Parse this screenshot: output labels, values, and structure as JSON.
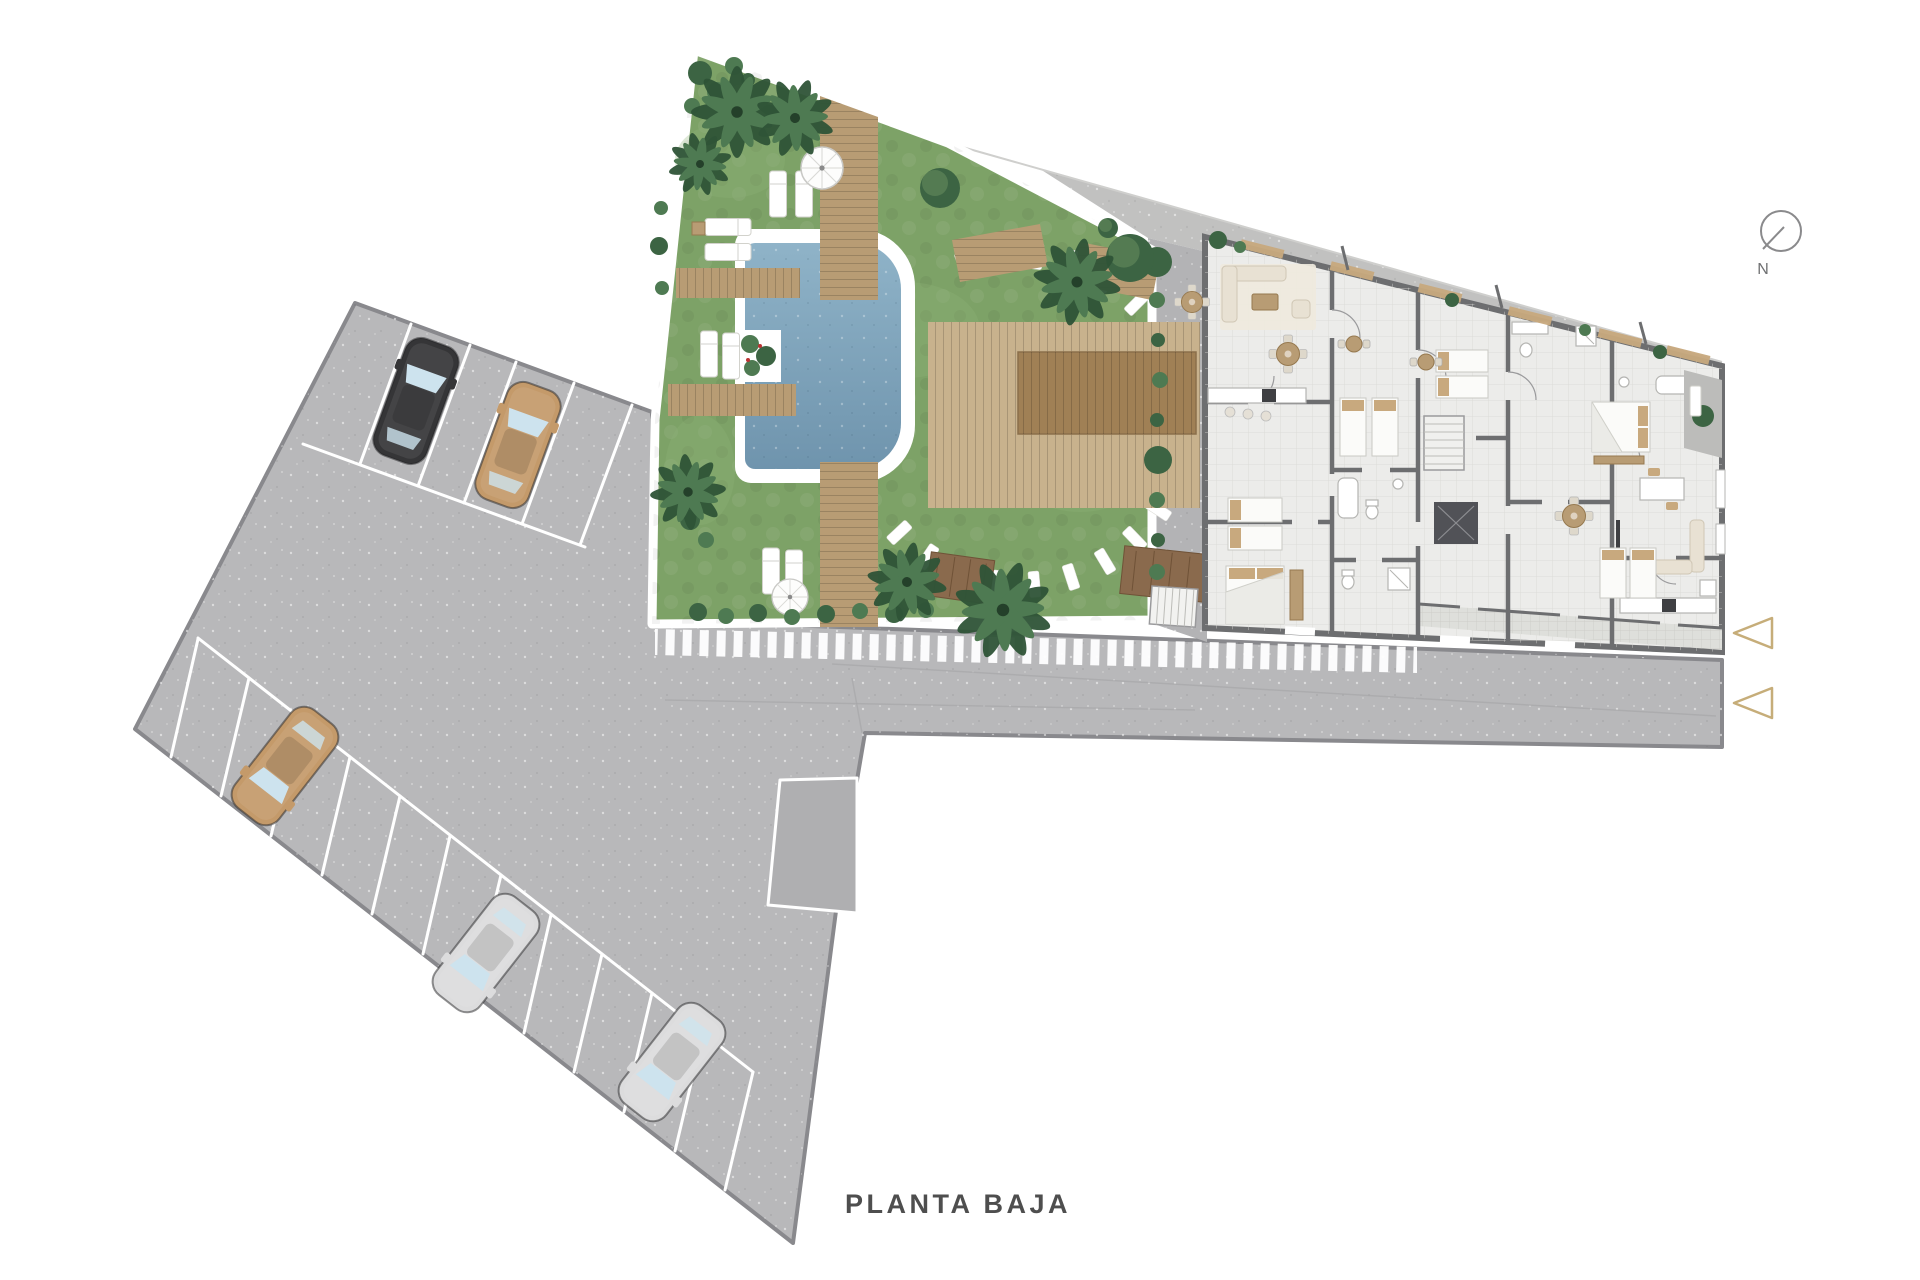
{
  "labels": {
    "title": "PLANTA BAJA",
    "north": "N"
  },
  "palette": {
    "asphalt": "#b8b8ba",
    "asphaltEdge": "#89898d",
    "courtyard": "#b3b3b5",
    "terraceStrip": "#c1c1c0",
    "lawn": "#7da267",
    "lawnLight": "#8fb377",
    "foliage": "#4e7a52",
    "foliageDark": "#3c6443",
    "wood": "#b89c74",
    "woodDark": "#a08055",
    "woodDeep": "#8a6a4d",
    "poolTop": "#8fb3c8",
    "poolBottom": "#6f94ad",
    "floor": "#ececea",
    "wall": "#6d6e70",
    "beige": "#e8e1d3",
    "tan": "#c8a97e",
    "rug": "#efe9dd",
    "carBlack": "#353537",
    "carTan": "#c49a6a",
    "carSilver": "#dcdcdd",
    "windshield": "#cde3ee",
    "arrow": "#c6ad79",
    "text": "#4e4e4e"
  },
  "scene": {
    "floor_name": "PLANTA BAJA",
    "areas": [
      "parking-lot",
      "access-street",
      "pool-garden",
      "apartment-building",
      "north-terraces",
      "side-courtyard"
    ],
    "parking": {
      "rows": [
        {
          "position": "north-east-edge",
          "marked_spaces": 5,
          "parked_cars": 2
        },
        {
          "position": "south-west-edge",
          "marked_spaces": 12,
          "parked_cars": 3
        },
        {
          "position": "street-corner",
          "marked_spaces": 1,
          "parked_cars": 0
        }
      ],
      "cars": [
        {
          "name": "car-black",
          "hex": "#353537"
        },
        {
          "name": "car-tan",
          "hex": "#c49a6a"
        },
        {
          "name": "car-tan",
          "hex": "#c49a6a"
        },
        {
          "name": "car-silver",
          "hex": "#dcdcdd"
        },
        {
          "name": "car-silver",
          "hex": "#dcdcdd"
        }
      ]
    },
    "garden": {
      "features": [
        "swimming-pool",
        "timber-deck-path",
        "timber-platform",
        "pergola",
        "parasols",
        "sun-loungers",
        "palm-trees",
        "stepping-stone-arc",
        "planter",
        "hedge",
        "striped-crosswalk-paving"
      ]
    },
    "building": {
      "rooms": [
        "living-dining",
        "kitchen",
        "bedroom",
        "bathroom",
        "elevator",
        "stairs",
        "terrace",
        "balcony"
      ],
      "entrance_arrows": 2
    },
    "compass": {
      "symbol": "circle-with-needle",
      "label": "N"
    }
  }
}
